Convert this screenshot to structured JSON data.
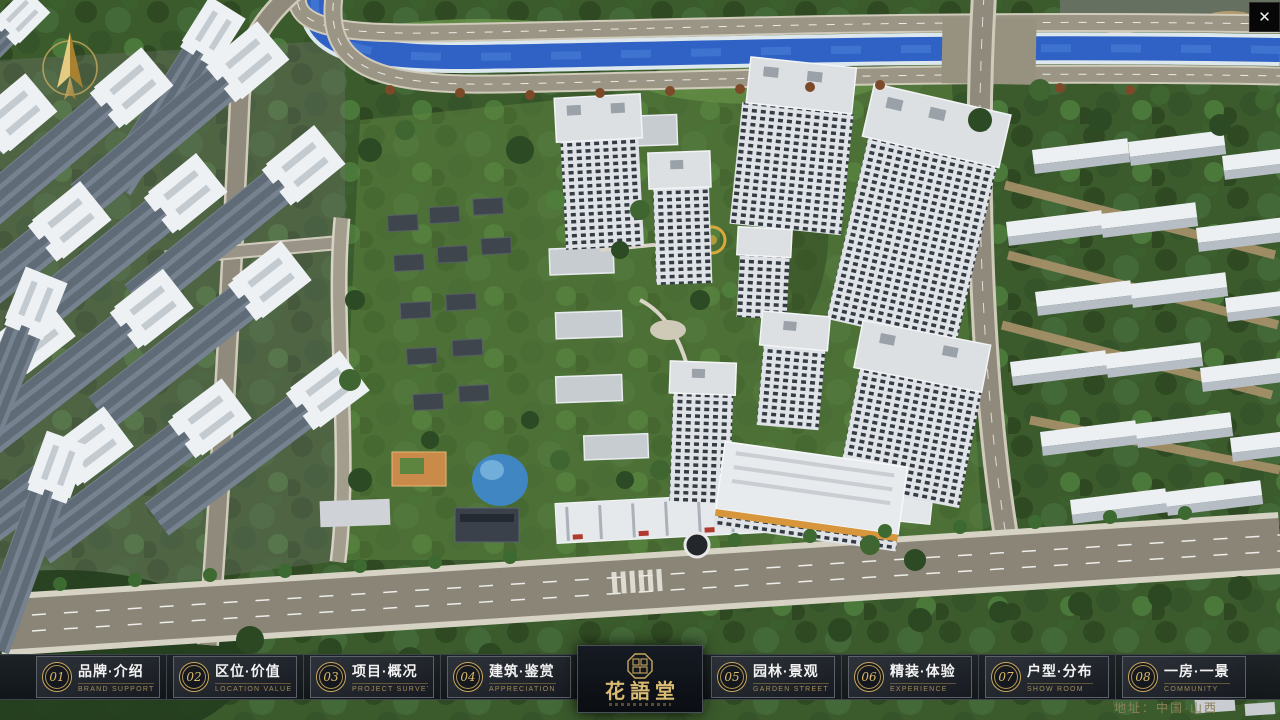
{
  "window": {
    "close": "✕"
  },
  "nav": {
    "items": [
      {
        "num": "01",
        "zh": "品牌·介绍",
        "en": "BRAND SUPPORT"
      },
      {
        "num": "02",
        "zh": "区位·价值",
        "en": "LOCATION VALUE"
      },
      {
        "num": "03",
        "zh": "项目·概况",
        "en": "PROJECT SURVEY"
      },
      {
        "num": "04",
        "zh": "建筑·鉴赏",
        "en": "APPRECIATION"
      },
      {
        "num": "05",
        "zh": "园林·景观",
        "en": "GARDEN STREET"
      },
      {
        "num": "06",
        "zh": "精装·体验",
        "en": "EXPERIENCE"
      },
      {
        "num": "07",
        "zh": "户型·分布",
        "en": "SHOW ROOM"
      },
      {
        "num": "08",
        "zh": "一房·一景",
        "en": "COMMUNITY"
      }
    ]
  },
  "logo": {
    "title": "花語堂"
  },
  "footer": {
    "address": "地址：中国·山西"
  },
  "colors": {
    "gold": "#c9a85c",
    "bar_bg": "#15181d",
    "river_blue": "#2f62c4",
    "panel_bg": "#0d1117"
  }
}
